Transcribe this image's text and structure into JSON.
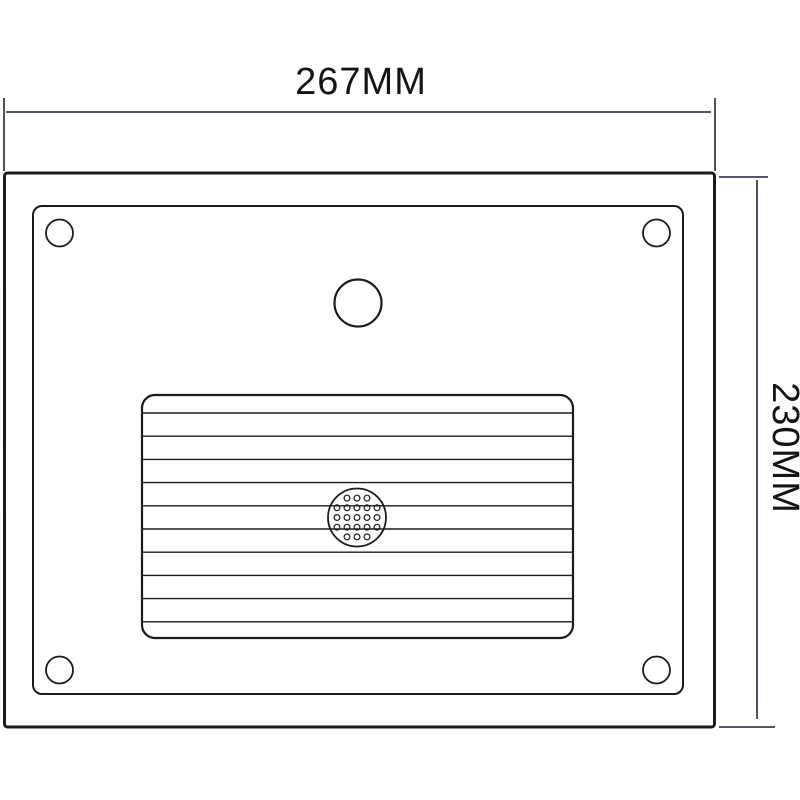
{
  "page": {
    "background": "#ffffff"
  },
  "diagram": {
    "type": "technical_dimension_drawing",
    "subject": "rectangular-panel-front-view",
    "dimensions": {
      "width_label": "267MM",
      "height_label": "230MM"
    },
    "colors": {
      "object_stroke": "#1b1b1b",
      "dimension_stroke": "#3d3d52",
      "label_text": "#141414",
      "background": "#ffffff"
    },
    "drawing": {
      "canvas": {
        "width": 800,
        "height": 800
      },
      "outer_rect": {
        "x": 4.5,
        "y": 173,
        "width": 710,
        "height": 554,
        "corner_radius": 3,
        "stroke_width": 3
      },
      "inner_rect": {
        "x": 33,
        "y": 206,
        "width": 650,
        "height": 488,
        "corner_radius": 9,
        "stroke_width": 2
      },
      "screw_holes": {
        "radius": 13.5,
        "stroke_width": 1.8,
        "centers": [
          [
            59.5,
            233
          ],
          [
            656.5,
            233
          ],
          [
            59.5,
            670
          ],
          [
            656.5,
            670
          ]
        ]
      },
      "top_circle": {
        "cx": 358,
        "cy": 303,
        "radius": 23.5,
        "stroke_width": 2.2
      },
      "ribbed_panel": {
        "x": 142,
        "y": 395,
        "width": 431,
        "height": 243,
        "corner_radius": 13,
        "stroke_width": 2.2,
        "rib_lines": {
          "count": 10,
          "first_offset": 18,
          "spacing": 23.2,
          "stroke_width": 1.4
        }
      },
      "speaker_grille": {
        "cx": 357,
        "cy": 517.5,
        "radius": 29,
        "stroke_width": 1.8,
        "holes": {
          "rows": [
            3,
            5,
            5,
            5,
            3
          ],
          "row_spacing": 9.7,
          "col_spacing": 10,
          "hole_radius": 2.9,
          "stroke_width": 1.2
        }
      },
      "width_dimension": {
        "stroke_width": 1.8,
        "line": {
          "x1": 6,
          "y1": 112,
          "x2": 711,
          "y2": 112
        },
        "extension_left": {
          "x1": 4,
          "y1": 98,
          "x2": 4,
          "y2": 171
        },
        "extension_right": {
          "x1": 715,
          "y1": 98,
          "x2": 715,
          "y2": 171
        }
      },
      "height_dimension": {
        "stroke_width": 1.8,
        "line": {
          "x1": 757,
          "y1": 180,
          "x2": 757,
          "y2": 719
        },
        "extension_top": {
          "x1": 719,
          "y1": 177,
          "x2": 768,
          "y2": 177
        },
        "extension_bottom": {
          "x1": 719,
          "y1": 727,
          "x2": 775,
          "y2": 727
        }
      }
    }
  }
}
